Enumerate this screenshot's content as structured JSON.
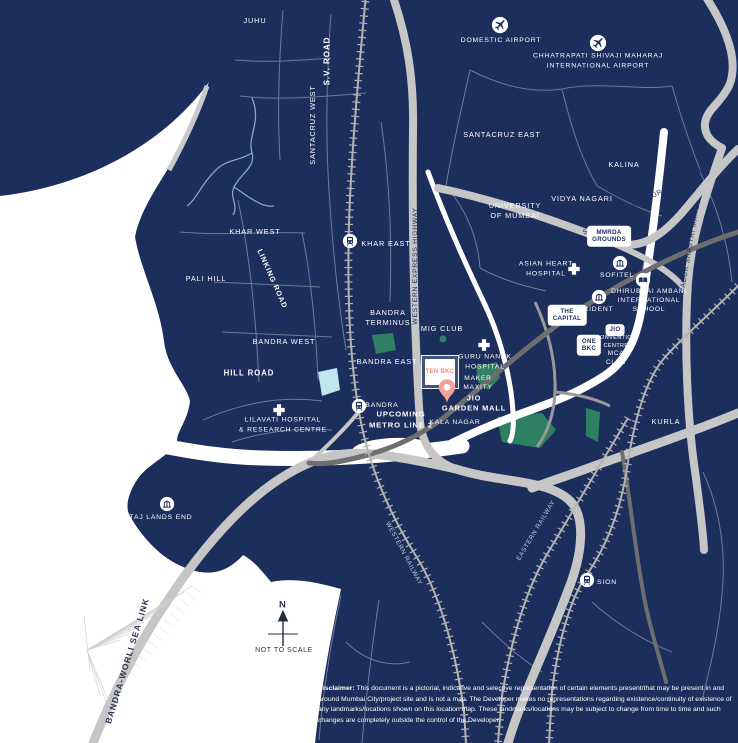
{
  "project": {
    "name": "TEN BKC",
    "pin_location": "JIO\nGARDEN MALL"
  },
  "areas": {
    "juhu": "JUHU",
    "santacruz_west": "SANTACRUZ WEST",
    "santacruz_east": "SANTACRUZ EAST",
    "kalina": "KALINA",
    "vidya_nagari": "VIDYA NAGARI",
    "university_of_mumbai": "UNIVERSITY\nOF MUMBAI",
    "khar_west": "KHAR WEST",
    "khar_east": "KHAR EAST",
    "pali_hill": "PALI HILL",
    "bandra_west": "BANDRA WEST",
    "bandra_east": "BANDRA EAST",
    "bandra_terminus": "BANDRA\nTERMINUS",
    "mig_club": "MIG CLUB",
    "maker_maxity": "MAKER\nMAXITY",
    "mca_club": "MCA\nCLUB",
    "kala_nagar": "KALA NAGAR",
    "kurla": "KURLA"
  },
  "roads": {
    "sv_road": "S.V. ROAD",
    "linking_road": "LINKING ROAD",
    "hill_road": "HILL ROAD",
    "western_express_highway": "WESTERN EXPRESS HIGHWAY",
    "santacruz_chembur_link_road": "SANTACRUZ-CHEMBUR LINK ROAD",
    "lal_bahadur_shastri_marg": "LAL BAHADUR SHASTRI MARG",
    "eastern_express_highway": "EASTERN EXPRESS HIGHWAY",
    "bandra_worli_sea_link": "BANDRA-WORLI SEA LINK"
  },
  "railways": {
    "western": "WESTERN RAILWAY",
    "eastern": "EASTERN RAILWAY",
    "upcoming_metro": "UPCOMING\nMETRO LINE 2"
  },
  "stations": {
    "bandra": "BANDRA",
    "sion": "SION"
  },
  "landmarks": {
    "domestic_airport": "DOMESTIC AIRPORT",
    "international_airport": "CHHATRAPATI SHIVAJI MAHARAJ\nINTERNATIONAL AIRPORT",
    "mmrda_grounds": "MMRDA\nGROUNDS",
    "asian_heart_hospital": "ASIAN HEART\nHOSPITAL",
    "sofitel": "SOFITEL",
    "trident": "TRIDENT",
    "dhirubhai_ambani_school": "DHIRUBHAI AMBANI\nINTERNATIONAL\nSCHOOL",
    "the_capital": "THE\nCAPITAL",
    "one_bkc": "ONE\nBKC",
    "jio": "JIO",
    "jio_convention_centre": "CONVENTION\nCENTRE",
    "guru_nanak_hospital": "GURU NANAK\nHOSPITAL",
    "lilavati_hospital": "LILAVATI HOSPITAL\n& RESEARCH CENTRE",
    "taj_lands_end": "TAJ LANDS END"
  },
  "compass": {
    "north": "N",
    "note": "NOT TO SCALE"
  },
  "disclaimer": {
    "label": "Disclaimer:",
    "text": " This document is a pictorial, indicative and selective representation of certain elements present/that may be present in and around Mumbai City/project site and is not a map. The Developer makes no representations regarding existence/continuity of existence of any landmarks/locations shown on this location map. These landmarks/locations may be subject to change from time to time and such changes are completely outside the control of the Developer."
  },
  "colors": {
    "land": "#1b2e5c",
    "sea": "#ffffff",
    "road": "#c6c6c6",
    "road_dark": "#6e6e6e",
    "railway": "#b3b3b3",
    "park_green": "#2f8063",
    "lake_blue": "#bfe6ec",
    "pin_salmon": "#f2a19b",
    "project_text_pink": "#ee8a82"
  }
}
